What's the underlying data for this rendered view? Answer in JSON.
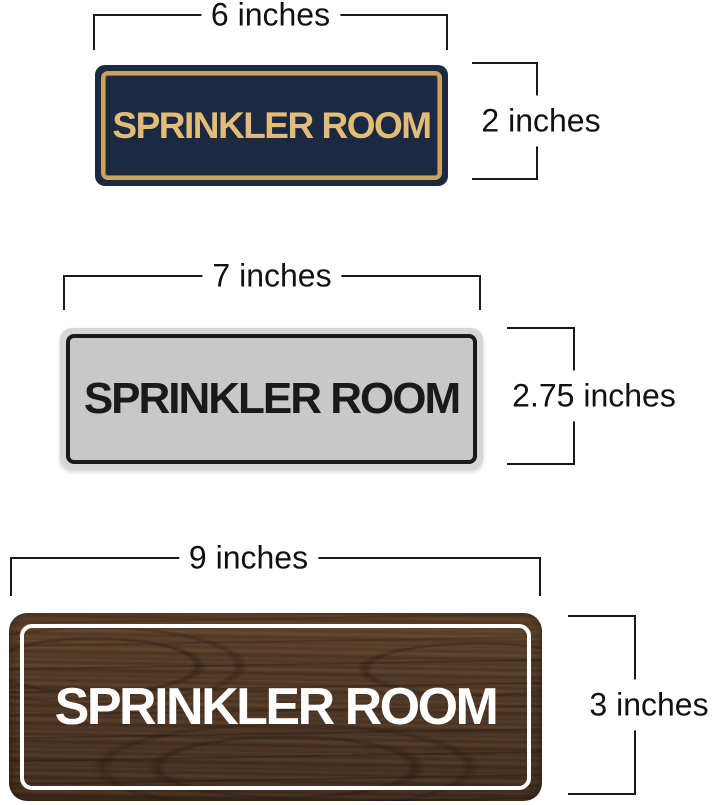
{
  "page": {
    "background": "#ffffff",
    "dimension_line_color": "#1a1a1a",
    "dimension_label_color": "#111111"
  },
  "signs": [
    {
      "name": "navy-gold-sprinkler-room-sign",
      "label": "SPRINKLER ROOM",
      "width_label": "6 inches",
      "height_label": "2 inches",
      "colors": {
        "background": "#1b2942",
        "border": "#c9a262",
        "text": "#e3bd77"
      }
    },
    {
      "name": "silver-black-sprinkler-room-sign",
      "label": "SPRINKLER ROOM",
      "width_label": "7 inches",
      "height_label": "2.75 inches",
      "colors": {
        "background": "#c8c8c8",
        "rim": "#d6d6d6",
        "border": "#1a1a1a",
        "text": "#1a1a1a"
      }
    },
    {
      "name": "walnut-white-sprinkler-room-sign",
      "label": "SPRINKLER ROOM",
      "width_label": "9 inches",
      "height_label": "3 inches",
      "colors": {
        "background": "#533a28",
        "grain_dark": "#3a2817",
        "grain_light": "#6b4e33",
        "border": "#ffffff",
        "text": "#ffffff"
      }
    }
  ]
}
